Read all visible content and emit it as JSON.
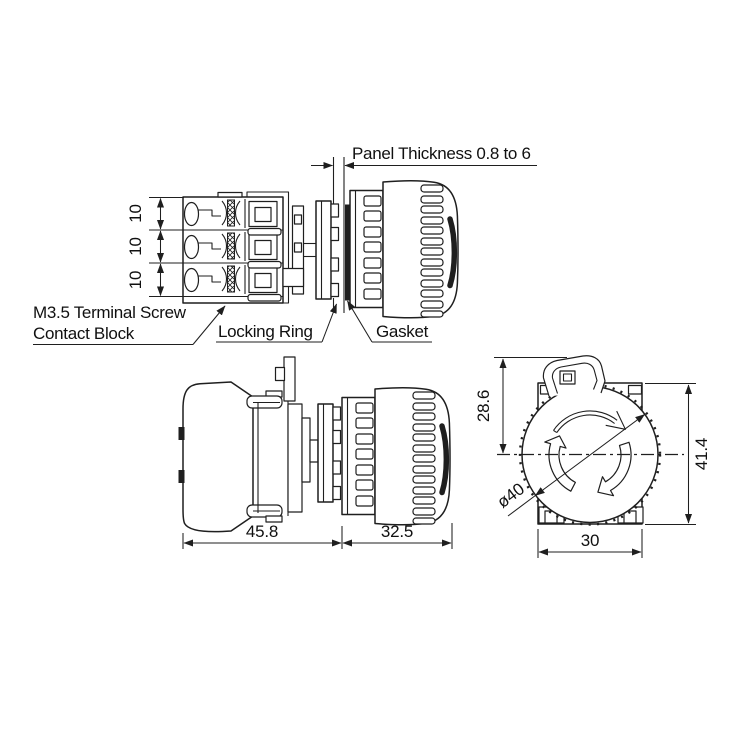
{
  "page": {
    "background": "#ffffff",
    "line_color": "#1f1f1f"
  },
  "exploded_view": {
    "panel_thickness_label": "Panel Thickness 0.8 to 6",
    "terminal_screw_label": "M3.5 Terminal Screw",
    "contact_block_label": "Contact Block",
    "locking_ring_label": "Locking Ring",
    "gasket_label": "Gasket",
    "terminal_pitch_dims": [
      "10",
      "10",
      "10"
    ]
  },
  "side_view": {
    "behind_panel_depth": "45.8",
    "front_projection": "32.5"
  },
  "front_view": {
    "center_from_top": "28.6",
    "total_height": "41.4",
    "button_diameter": "ø40",
    "body_width": "30"
  }
}
